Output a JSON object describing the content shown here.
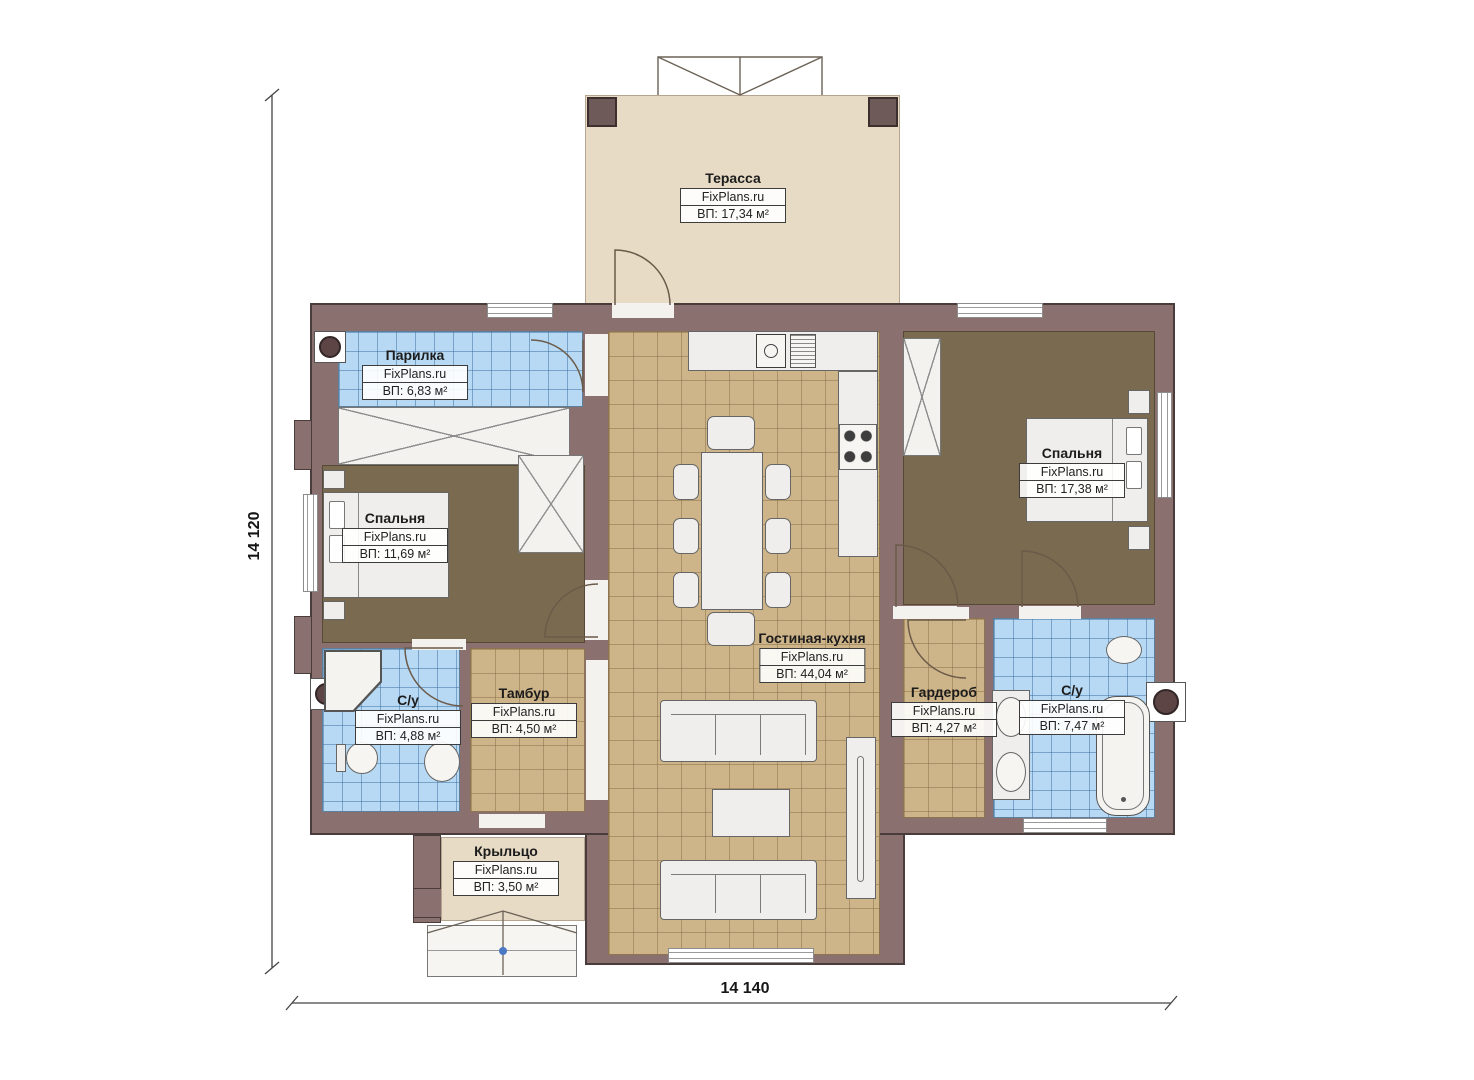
{
  "brand": "FixPlans.ru",
  "dimensions": {
    "horizontal": "14 140",
    "vertical": "14 120"
  },
  "rooms": [
    {
      "id": "terrace",
      "name": "Терасса",
      "source": "FixPlans.ru",
      "area": "ВП: 17,34 м²"
    },
    {
      "id": "steam-room",
      "name": "Парилка",
      "source": "FixPlans.ru",
      "area": "ВП: 6,83 м²"
    },
    {
      "id": "bedroom-left",
      "name": "Спальня",
      "source": "FixPlans.ru",
      "area": "ВП: 11,69 м²"
    },
    {
      "id": "bedroom-right",
      "name": "Спальня",
      "source": "FixPlans.ru",
      "area": "ВП: 17,38 м²"
    },
    {
      "id": "living-kitchen",
      "name": "Гостиная-кухня",
      "source": "FixPlans.ru",
      "area": "ВП: 44,04 м²"
    },
    {
      "id": "bathroom-left",
      "name": "С/у",
      "source": "FixPlans.ru",
      "area": "ВП: 4,88 м²"
    },
    {
      "id": "vestibule",
      "name": "Тамбур",
      "source": "FixPlans.ru",
      "area": "ВП: 4,50 м²"
    },
    {
      "id": "wardrobe",
      "name": "Гардероб",
      "source": "FixPlans.ru",
      "area": "ВП: 4,27 м²"
    },
    {
      "id": "bathroom-right",
      "name": "С/у",
      "source": "FixPlans.ru",
      "area": "ВП: 7,47 м²"
    },
    {
      "id": "porch",
      "name": "Крыльцо",
      "source": "FixPlans.ru",
      "area": "ВП: 3,50 м²"
    }
  ],
  "palette": {
    "wall": "#8a7170",
    "tile_blue": "#b7d9f3",
    "tile_tan": "#cdb489",
    "floor_brown": "#7a6a4f",
    "terrace_beige": "#e7dbc6"
  }
}
